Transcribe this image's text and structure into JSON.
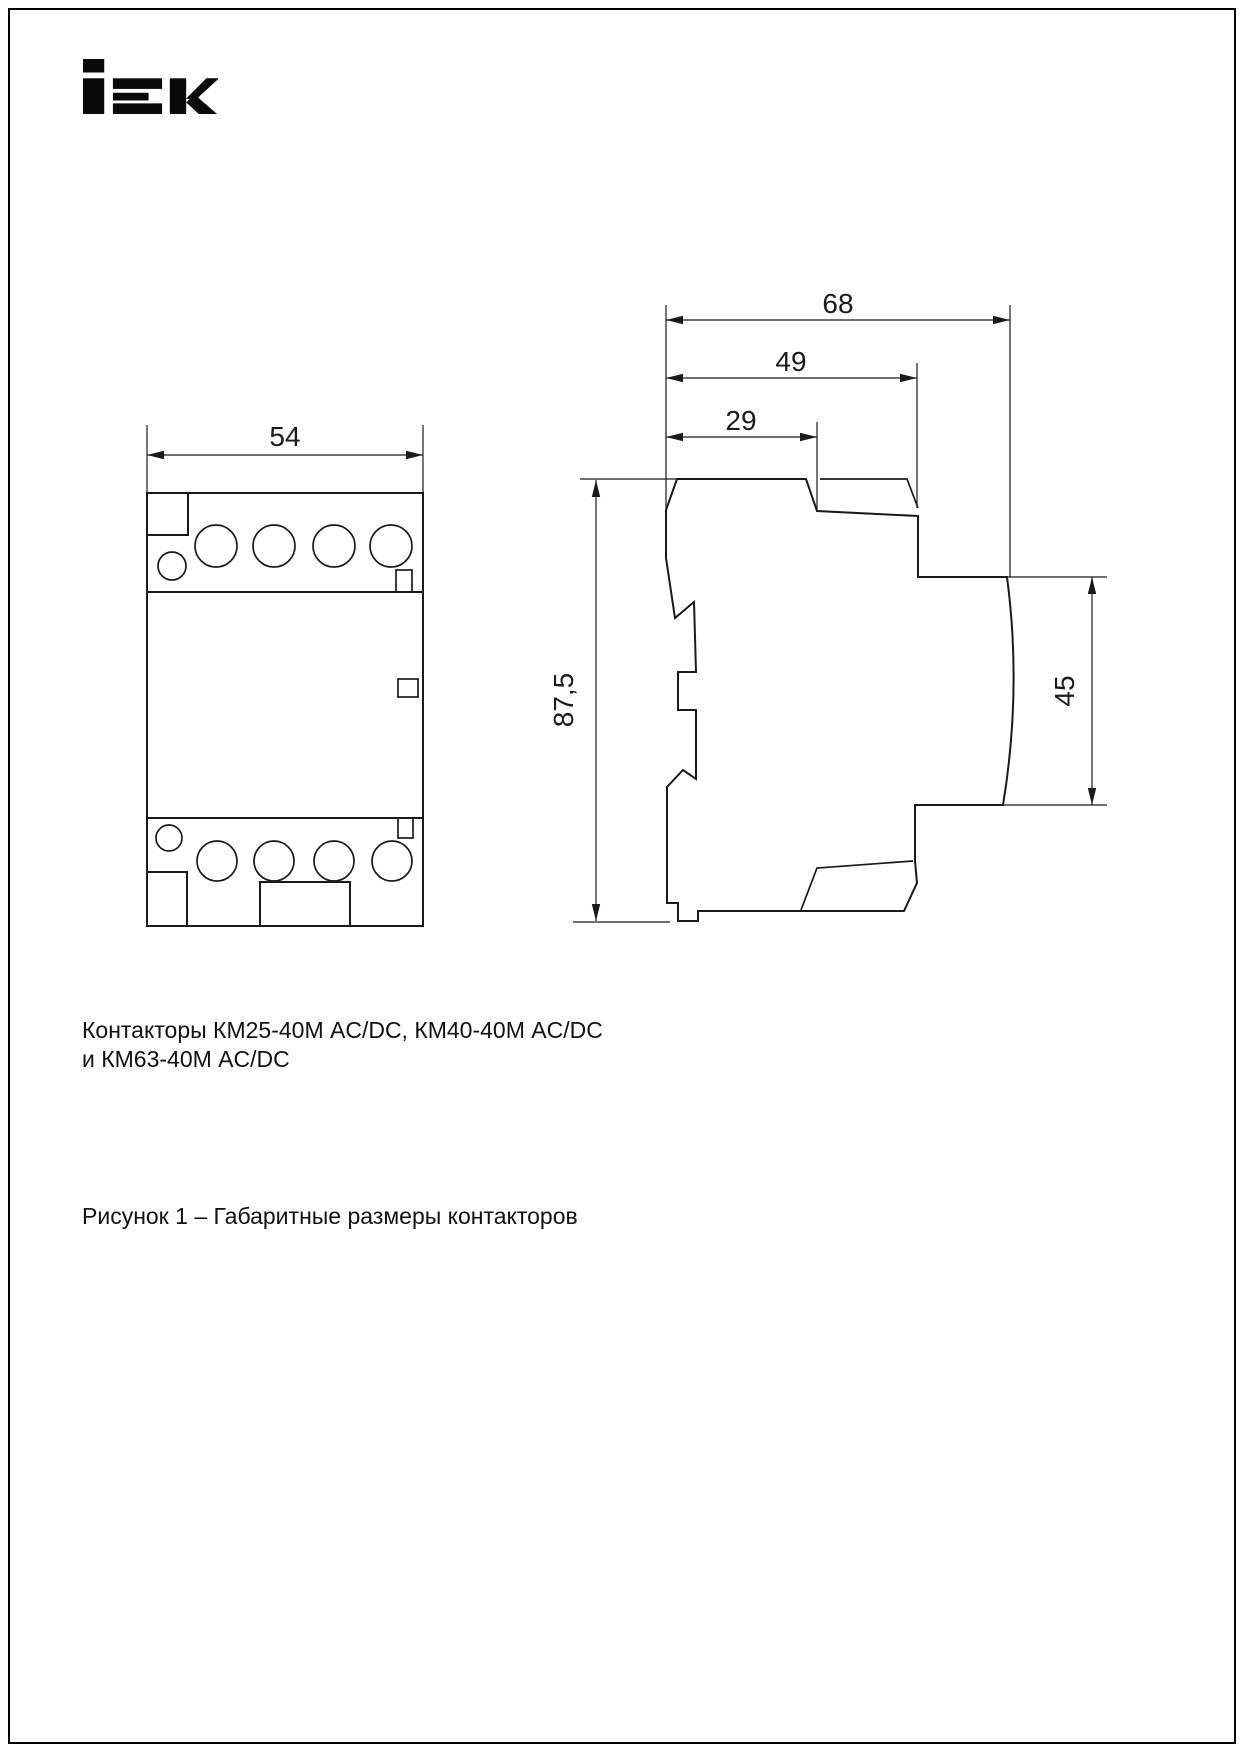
{
  "logo": {
    "text": "iEK"
  },
  "front_view": {
    "width_dim": "54"
  },
  "side_view": {
    "total_width_dim": "68",
    "mid_width_dim": "49",
    "top_width_dim": "29",
    "height_dim": "87,5",
    "front_height_dim": "45"
  },
  "caption": {
    "line1": "Контакторы КМ25-40М AC/DC, КМ40-40М AC/DC",
    "line2": "и КМ63-40М AC/DC"
  },
  "figure_caption": "Рисунок 1 – Габаритные размеры контакторов"
}
